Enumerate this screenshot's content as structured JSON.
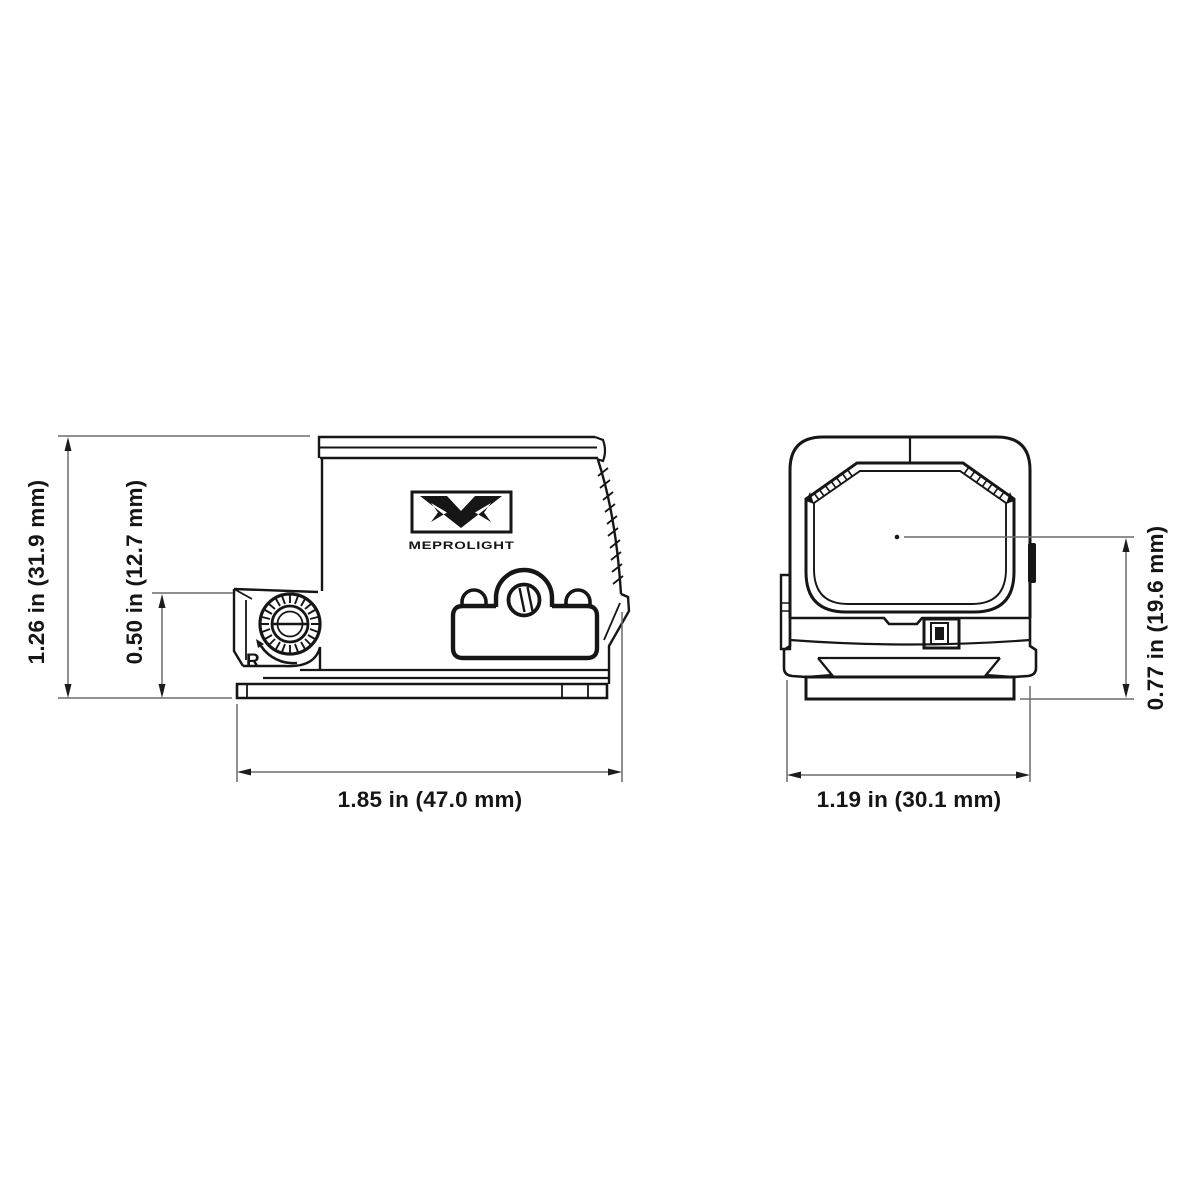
{
  "drawing": {
    "background": "#ffffff",
    "ink_color": "#161616",
    "dim_line_color": "#6b6b6b",
    "logo": {
      "wordmark": "MEPROLIGHT"
    },
    "side_view": {
      "rotation_label": "R",
      "dimensions": {
        "overall_height": "1.26 in (31.9 mm)",
        "adjuster_height": "0.50 in (12.7 mm)",
        "overall_length": "1.85 in (47.0 mm)"
      }
    },
    "front_view": {
      "dimensions": {
        "overall_width": "1.19 in (30.1 mm)",
        "axis_height": "0.77 in (19.6 mm)"
      }
    }
  }
}
